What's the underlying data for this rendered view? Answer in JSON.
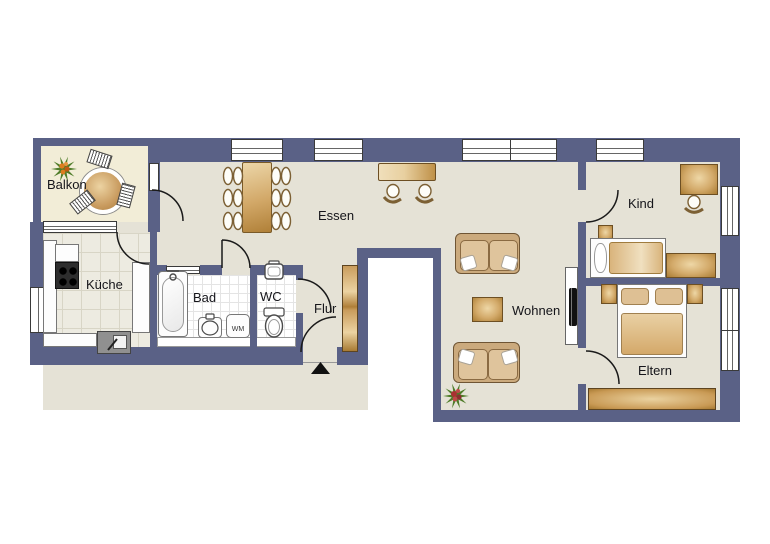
{
  "labels": {
    "balkon": "Balkon",
    "kueche": "Küche",
    "bad": "Bad",
    "wc": "WC",
    "flur": "Flur",
    "essen": "Essen",
    "wohnen": "Wohnen",
    "kind": "Kind",
    "eltern": "Eltern",
    "washing_machine": "WM"
  },
  "colors": {
    "wall": "#5a6186",
    "floor": "#e5e2d6",
    "balcony_floor": "#f2edd7",
    "wood_light": "#eed7a6",
    "wood_dark": "#aa7c33",
    "sofa": "#cbaa7d",
    "plant_green": "#4e7c28",
    "flower_red": "#a83232",
    "berry_orange": "#dd7d1e",
    "tv_black": "#111111"
  }
}
